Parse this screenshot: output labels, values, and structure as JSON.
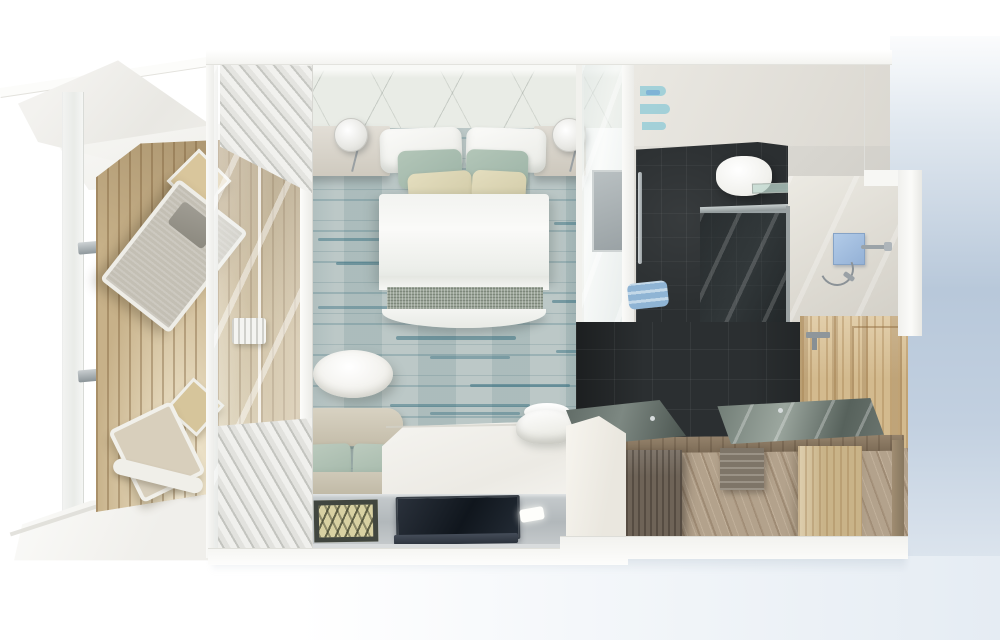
{
  "scene": {
    "type": "architectural-3d-render",
    "view": "top-down cutaway floor plan",
    "subject": "Cruise ship balcony cabin suite rendered from above, no text or UI controls visible",
    "rooms": [
      {
        "name": "balcony",
        "floor": "teak wood planks",
        "features": [
          "white ship hull cutaway planes",
          "glass balustrade with chrome railing brackets",
          "square side table upper",
          "grey sling lounge chair",
          "square side table lower",
          "white deck chair with footrest",
          "white deck platform"
        ]
      },
      {
        "name": "bedroom",
        "floor": "light blue-grey carpet with teal streak stripes",
        "features": [
          "white quilted headboard wall",
          "left nightstand",
          "right nightstand",
          "round white wall sconce left",
          "round white wall sconce right",
          "double bed with two white pillows",
          "two sage green pillows",
          "two cream lumbar pillows",
          "white duvet",
          "grey textured bed runner",
          "rounded white footboard",
          "white oval pedestal table",
          "beige loveseat with two sage cushions",
          "white dresser desk surface",
          "white upholstered desk chair",
          "glass media console shelf",
          "dark framed bench mat with zigzag pattern",
          "flat TV lying on console",
          "two recessed light strips",
          "white sheer curtain stacks at window wall",
          "sliding glass door with mirror panel to bathroom"
        ]
      },
      {
        "name": "bathroom",
        "floor": "dark slate tiles and diagonal wood planks",
        "features": [
          "concrete-look walls",
          "glass shelves with blue towels",
          "chrome towel bar",
          "rolled blue towels",
          "white wall-hung toilet",
          "dark glass shower front",
          "glass ledge",
          "shower stall",
          "blue glass shower control panel",
          "chrome shower arm and head",
          "handheld shower hose",
          "dark slate feature wall",
          "light wood panelled wall with seam",
          "chrome wall faucet",
          "left vanity with dark glass top and faucet",
          "white vanity front panel",
          "right vanity glass top with faucet",
          "wood counter frame beam",
          "dark wood support post",
          "slatted vanity shelf",
          "light wood support post"
        ]
      }
    ]
  },
  "colors": {
    "background_blue": "#b8c8da",
    "deck_wood": "#c7b189",
    "carpet_base": "#b4c2c1",
    "carpet_stripe": "#2f6a7c",
    "pillow_sage": "#9cb3a6",
    "pillow_cream": "#d2cba8",
    "sofa_beige": "#c4bdaa",
    "runner_gray": "#9aa497",
    "band_grey": "#b2b8bb",
    "tv_screen": "#10161d",
    "bath_wall": "#d6d4ce",
    "slate_dark": "#2b2f31",
    "wood_wall": "#d3ba8e",
    "wood_floor": "#b3a28c",
    "vanity_glass": "#7d8882",
    "shower_blue": "#94b1d6"
  }
}
